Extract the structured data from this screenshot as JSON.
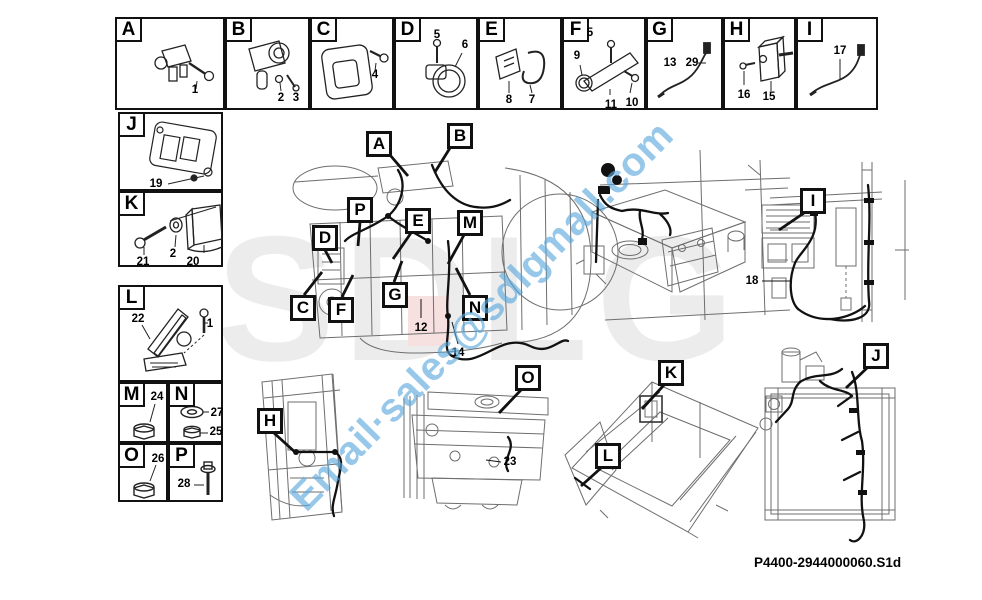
{
  "watermark": {
    "email": "Email·sales@sdlgmall.com",
    "logo": "SDLG"
  },
  "footer": {
    "part_number": "P4400-2944000060.S1d"
  },
  "colors": {
    "watermark_blue": "#58a8dc",
    "logo_gray": "#ececec",
    "accent_pink": "#f7e0e0",
    "line_black": "#111111"
  },
  "legend": {
    "A": {
      "letter": "A",
      "nums": {
        "n1": "1"
      }
    },
    "B": {
      "letter": "B",
      "nums": {
        "n2": "2",
        "n3": "3"
      }
    },
    "C": {
      "letter": "C",
      "nums": {
        "n4": "4"
      }
    },
    "D": {
      "letter": "D",
      "nums": {
        "n5": "5",
        "n6": "6"
      }
    },
    "E": {
      "letter": "E",
      "nums": {
        "n8": "8",
        "n7": "7"
      }
    },
    "F": {
      "letter": "F",
      "nums": {
        "n9": "9",
        "n5": "5",
        "n11": "11",
        "n10": "10"
      }
    },
    "G": {
      "letter": "G",
      "nums": {
        "n13": "13",
        "n29": "29"
      }
    },
    "H": {
      "letter": "H",
      "nums": {
        "n16": "16",
        "n15": "15"
      }
    },
    "I": {
      "letter": "I",
      "nums": {
        "n17": "17"
      }
    },
    "J": {
      "letter": "J",
      "nums": {
        "n19": "19"
      }
    },
    "K": {
      "letter": "K",
      "nums": {
        "n21": "21",
        "n2": "2",
        "n20": "20"
      }
    },
    "L": {
      "letter": "L",
      "nums": {
        "n22": "22",
        "n1": "1"
      }
    },
    "M": {
      "letter": "M",
      "nums": {
        "n24": "24"
      }
    },
    "N": {
      "letter": "N",
      "nums": {
        "n27": "27",
        "n25": "25"
      }
    },
    "O": {
      "letter": "O",
      "nums": {
        "n26": "26"
      }
    },
    "P": {
      "letter": "P",
      "nums": {
        "n28": "28"
      }
    }
  },
  "diagram": {
    "callouts": {
      "A": "A",
      "B": "B",
      "C": "C",
      "D": "D",
      "E": "E",
      "F": "F",
      "G": "G",
      "H": "H",
      "I": "I",
      "J": "J",
      "K": "K",
      "L": "L",
      "M": "M",
      "N": "N",
      "O": "O",
      "P": "P"
    },
    "numbers": {
      "n12": "12",
      "n14": "14",
      "n18": "18",
      "n23": "23"
    }
  }
}
